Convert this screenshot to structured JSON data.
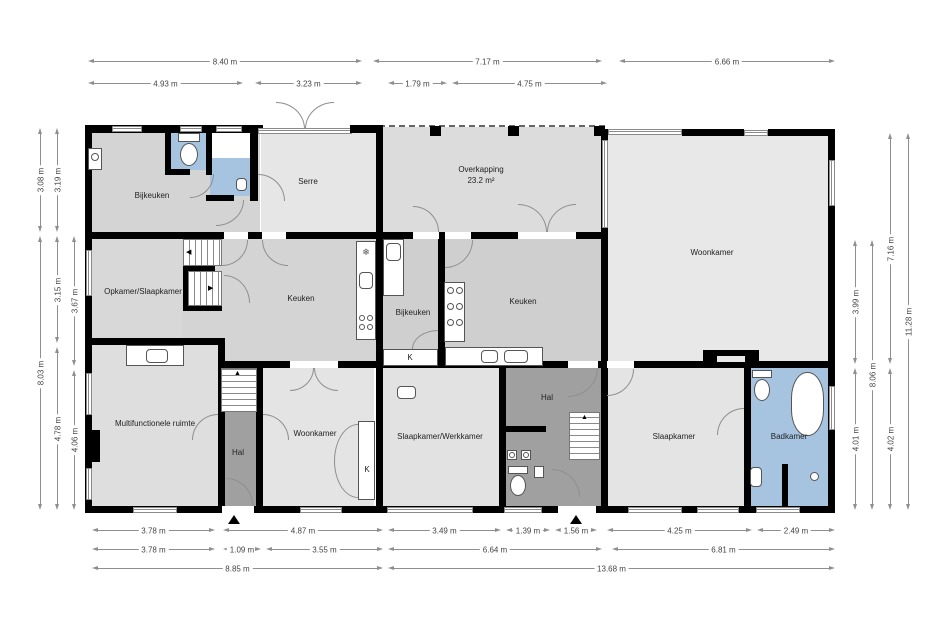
{
  "rooms": {
    "bijkeuken_top": "Bijkeuken",
    "serre": "Serre",
    "overkapping": "Overkapping",
    "overkapping_area": "23.2 m²",
    "woonkamer_right": "Woonkamer",
    "opkamer_slaapkamer": "Opkamer/Slaapkamer",
    "keuken_left": "Keuken",
    "bijkeuken_mid": "Bijkeuken",
    "keuken_mid": "Keuken",
    "multifunctionele_ruimte": "Multifunctionele ruimte",
    "hal_left": "Hal",
    "woonkamer_bottom": "Woonkamer",
    "slaapkamer_werkkamer": "Slaapkamer/Werkkamer",
    "hal_right": "Hal",
    "slaapkamer": "Slaapkamer",
    "badkamer": "Badkamer",
    "kast_1": "K",
    "kast_2": "K"
  },
  "dimensions": {
    "top_row1": [
      "8.40 m",
      "7.17 m",
      "6.66 m"
    ],
    "top_row2": [
      "4.93 m",
      "3.23 m",
      "1.79 m",
      "4.75 m"
    ],
    "bottom_row1": [
      "3.78 m",
      "4.87 m",
      "3.49 m",
      "1.39 m",
      "1.56 m",
      "4.25 m",
      "2.49 m"
    ],
    "bottom_row2": [
      "3.78 m",
      "1.09 m",
      "3.55 m",
      "6.64 m",
      "6.81 m"
    ],
    "bottom_row3": [
      "8.85 m",
      "13.68 m"
    ],
    "left_col1": [
      "3.08 m",
      "8.03 m"
    ],
    "left_col2": [
      "3.19 m",
      "3.15 m",
      "4.78 m"
    ],
    "left_col3": [
      "3.67 m",
      "4.06 m"
    ],
    "right_col1": [
      "3.99 m",
      "4.01 m"
    ],
    "right_col2": [
      "8.06 m"
    ],
    "right_col3": [
      "7.16 m",
      "4.02 m"
    ],
    "right_col4": [
      "11.28 m"
    ]
  },
  "colors": {
    "wall": "#000000",
    "room_gray": "#d4d4d4",
    "room_light": "#e6e6e6",
    "hall_dark": "#a0a0a0",
    "wet_blue": "#a6c3e0",
    "dim_line": "#8f8f8f"
  }
}
